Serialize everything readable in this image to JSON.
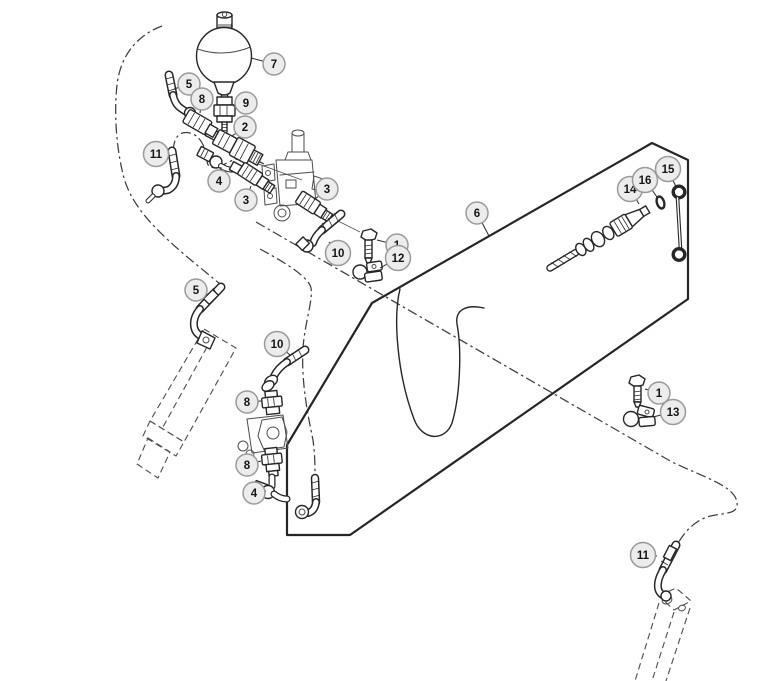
{
  "diagram": {
    "type": "exploded-parts-diagram",
    "background": "#ffffff",
    "line_color": "#272727",
    "phantom_line_color": "#3e3e3e",
    "callout_fill": "#ececec",
    "callout_stroke": "#9a9a9a",
    "callout_text_color": "#151515"
  },
  "callouts": [
    {
      "label": "1",
      "x": 397,
      "y": 245,
      "tx": 377,
      "ty": 240
    },
    {
      "label": "1",
      "x": 659,
      "y": 393,
      "tx": 645,
      "ty": 389
    },
    {
      "label": "2",
      "x": 245,
      "y": 127,
      "tx": 232,
      "ty": 136
    },
    {
      "label": "3",
      "x": 246,
      "y": 200,
      "tx": 251,
      "ty": 186
    },
    {
      "label": "3",
      "x": 327,
      "y": 189,
      "tx": 314,
      "ty": 200
    },
    {
      "label": "4",
      "x": 219,
      "y": 181,
      "tx": 221,
      "ty": 167
    },
    {
      "label": "4",
      "x": 254,
      "y": 493,
      "tx": 266,
      "ty": 491
    },
    {
      "label": "5",
      "x": 189,
      "y": 84,
      "tx": 174,
      "ty": 89
    },
    {
      "label": "5",
      "x": 196,
      "y": 290,
      "tx": 208,
      "ty": 295
    },
    {
      "label": "6",
      "x": 477,
      "y": 213,
      "tx": 489,
      "ty": 236
    },
    {
      "label": "7",
      "x": 274,
      "y": 64,
      "tx": 251,
      "ty": 58
    },
    {
      "label": "8",
      "x": 202,
      "y": 99,
      "tx": 200,
      "ty": 113
    },
    {
      "label": "8",
      "x": 247,
      "y": 402,
      "tx": 261,
      "ty": 401
    },
    {
      "label": "8",
      "x": 247,
      "y": 465,
      "tx": 261,
      "ty": 461
    },
    {
      "label": "9",
      "x": 246,
      "y": 103,
      "tx": 233,
      "ty": 106
    },
    {
      "label": "10",
      "x": 338,
      "y": 253,
      "tx": 329,
      "ty": 242
    },
    {
      "label": "10",
      "x": 277,
      "y": 344,
      "tx": 290,
      "ty": 355
    },
    {
      "label": "11",
      "x": 156,
      "y": 154,
      "tx": 169,
      "ty": 157
    },
    {
      "label": "11",
      "x": 643,
      "y": 555,
      "tx": 657,
      "ty": 556
    },
    {
      "label": "12",
      "x": 398,
      "y": 258,
      "tx": 380,
      "ty": 268
    },
    {
      "label": "13",
      "x": 673,
      "y": 412,
      "tx": 653,
      "ty": 417
    },
    {
      "label": "14",
      "x": 630,
      "y": 189,
      "tx": 639,
      "ty": 204
    },
    {
      "label": "15",
      "x": 668,
      "y": 169,
      "tx": 676,
      "ty": 187
    },
    {
      "label": "16",
      "x": 645,
      "y": 180,
      "tx": 657,
      "ty": 197
    }
  ]
}
